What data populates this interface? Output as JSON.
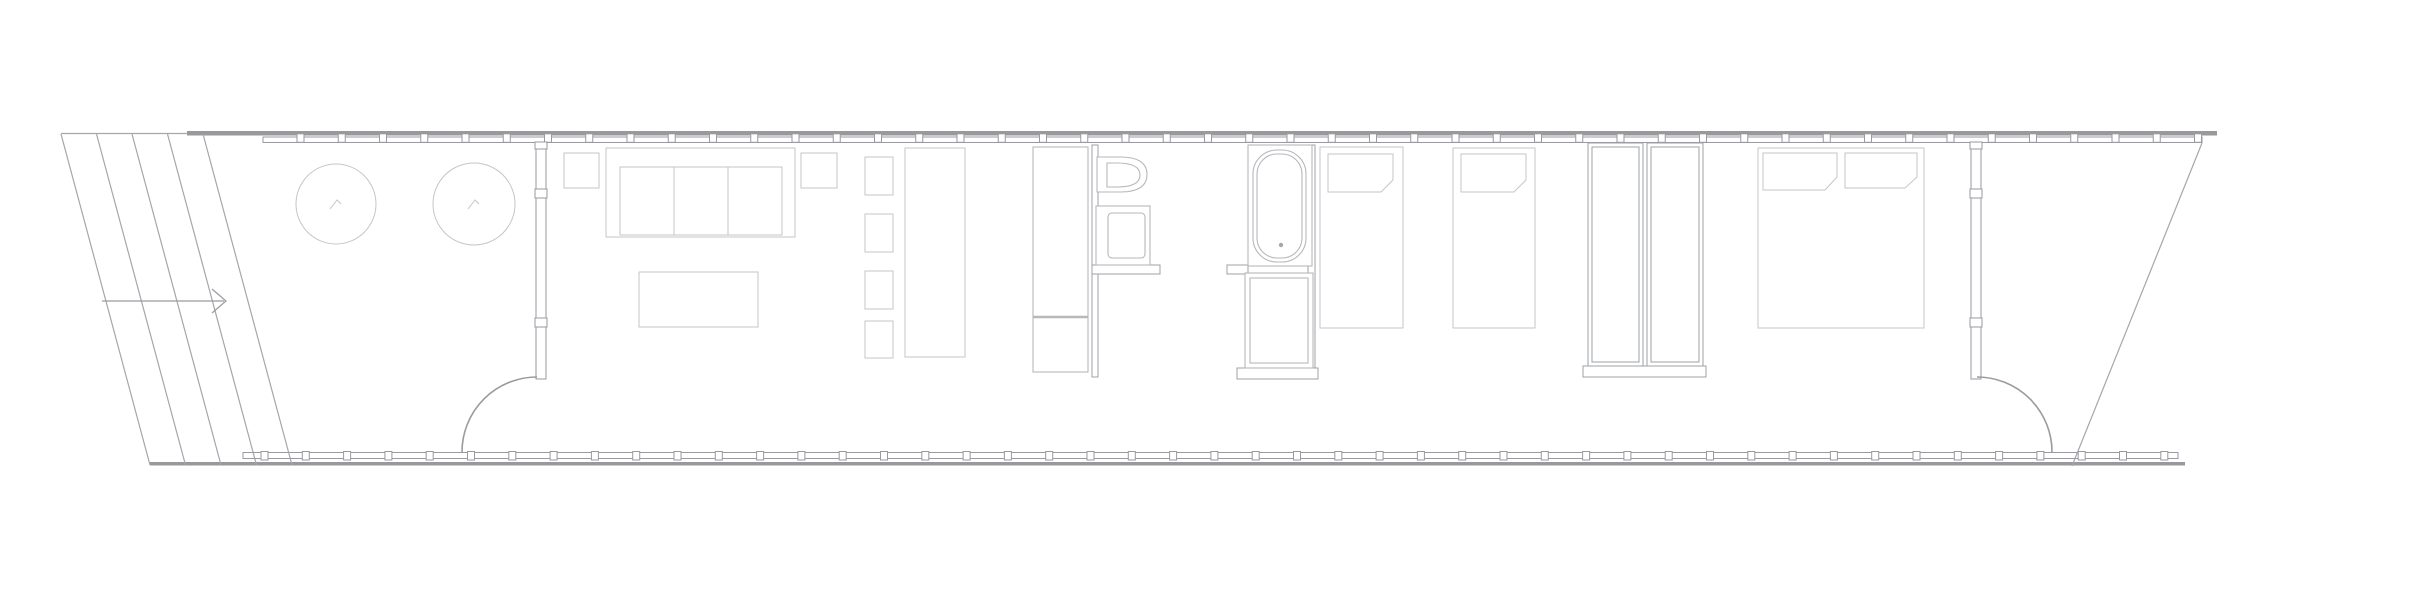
{
  "meta": {
    "title": "Elongated pavilion floor plan — line drawing",
    "canvas": {
      "width": 2409,
      "height": 600,
      "background": "#ffffff"
    },
    "palette": {
      "thick_edge": "#98989d",
      "outline": "#a6a6ab",
      "facade": "#9a9aa0",
      "partition": "#9fa0a4",
      "fixture": "#b7b7bc",
      "furniture": "#c6c6ca",
      "annotation": "#9a9aa0",
      "paper": "#ffffff"
    }
  },
  "layers": [
    {
      "name": "roof-and-deck-edges",
      "stroke": "none",
      "fill": "#98989d",
      "items": [
        {
          "n": "roof-fascia-top",
          "t": "rect",
          "x": 187,
          "y": 131,
          "w": 2030,
          "h": 4.5
        },
        {
          "n": "deck-edge-bottom",
          "t": "rect",
          "x": 150,
          "y": 462,
          "w": 2035,
          "h": 3.5
        }
      ]
    },
    {
      "name": "site-outline-and-ramp",
      "stroke": "#a6a6ab",
      "sw": 1.2,
      "fill": "none",
      "items": [
        {
          "n": "ramp-top-edge",
          "t": "line",
          "x1": 61,
          "y1": 133.5,
          "x2": 187,
          "y2": 133.5
        },
        {
          "n": "ramp-edge-1",
          "t": "line",
          "x1": 61,
          "y1": 134,
          "x2": 150,
          "y2": 465
        },
        {
          "n": "ramp-edge-2",
          "t": "line",
          "x1": 96.5,
          "y1": 134,
          "x2": 185.5,
          "y2": 465
        },
        {
          "n": "ramp-edge-3",
          "t": "line",
          "x1": 132,
          "y1": 134,
          "x2": 221,
          "y2": 465
        },
        {
          "n": "ramp-edge-4",
          "t": "line",
          "x1": 167.5,
          "y1": 134,
          "x2": 256.5,
          "y2": 465
        },
        {
          "n": "ramp-edge-5",
          "t": "line",
          "x1": 203,
          "y1": 134,
          "x2": 292,
          "y2": 465
        },
        {
          "n": "deck-edge-right-diagonal",
          "t": "line",
          "x1": 2202,
          "y1": 143,
          "x2": 2072,
          "y2": 466
        }
      ]
    },
    {
      "name": "glazed-facades",
      "stroke": "#9a9aa0",
      "sw": 1,
      "fill": "#ffffff",
      "items": [
        {
          "n": "glazed-facade-top",
          "t": "rect",
          "x": 263,
          "y": 137,
          "w": 1939,
          "h": 5.5,
          "f": "none"
        },
        {
          "n": "glazed-facade-bottom",
          "t": "rect",
          "x": 243,
          "y": 452.5,
          "w": 1935,
          "h": 6,
          "f": "none"
        },
        {
          "n": "facade-mullions-top",
          "t": "ticks",
          "x0": 297,
          "y": 133.8,
          "step": 41.25,
          "count": 47,
          "w": 7,
          "h": 8.5
        },
        {
          "n": "facade-mullions-bottom",
          "t": "ticks",
          "x0": 261,
          "y": 451.5,
          "step": 41.3,
          "count": 47,
          "w": 7,
          "h": 8.5
        },
        {
          "n": "entry-wall-left",
          "t": "rect",
          "x": 536,
          "y": 142,
          "w": 10,
          "h": 237
        },
        {
          "n": "entry-wall-left-mullion-1",
          "t": "rect",
          "x": 535,
          "y": 142,
          "w": 12,
          "h": 7
        },
        {
          "n": "entry-wall-left-mullion-2",
          "t": "rect",
          "x": 535,
          "y": 189,
          "w": 12,
          "h": 9
        },
        {
          "n": "entry-wall-left-mullion-3",
          "t": "rect",
          "x": 535,
          "y": 318,
          "w": 12,
          "h": 9
        },
        {
          "n": "entry-wall-right",
          "t": "rect",
          "x": 1971,
          "y": 142,
          "w": 10,
          "h": 237
        },
        {
          "n": "entry-wall-right-mullion-1",
          "t": "rect",
          "x": 1970,
          "y": 142,
          "w": 12,
          "h": 7
        },
        {
          "n": "entry-wall-right-mullion-2",
          "t": "rect",
          "x": 1970,
          "y": 189,
          "w": 12,
          "h": 9
        },
        {
          "n": "entry-wall-right-mullion-3",
          "t": "rect",
          "x": 1970,
          "y": 318,
          "w": 12,
          "h": 9
        },
        {
          "n": "entry-door-left-swing",
          "t": "path",
          "d": "M537,377 A75,75 0 0 0 462,452",
          "sw": 1.6,
          "f": "none"
        },
        {
          "n": "entry-door-right-swing",
          "t": "path",
          "d": "M1977,377 A75,75 0 0 1 2052,452",
          "sw": 1.6,
          "f": "none"
        }
      ]
    },
    {
      "name": "interior-partitions",
      "stroke": "#9fa0a4",
      "sw": 1,
      "fill": "#ffffff",
      "items": [
        {
          "n": "bathroom-wall-left",
          "t": "rect",
          "x": 1092,
          "y": 145,
          "w": 6,
          "h": 232
        },
        {
          "n": "bathroom-wall-right",
          "t": "rect",
          "x": 1308,
          "y": 145,
          "w": 7,
          "h": 232
        },
        {
          "n": "bathroom-halfwall-left",
          "t": "rect",
          "x": 1092,
          "y": 265,
          "w": 68,
          "h": 9
        },
        {
          "n": "bathroom-halfwall-right",
          "t": "rect",
          "x": 1227,
          "y": 265,
          "w": 21,
          "h": 9
        },
        {
          "n": "bathroom-wall-bottom",
          "t": "rect",
          "x": 1237,
          "y": 368,
          "w": 81,
          "h": 11
        },
        {
          "n": "wardrobe-1",
          "t": "rect",
          "x": 1588,
          "y": 143,
          "w": 55,
          "h": 223
        },
        {
          "n": "wardrobe-1-inner",
          "t": "rect",
          "x": 1592,
          "y": 147,
          "w": 47,
          "h": 215,
          "f": "none"
        },
        {
          "n": "wardrobe-2",
          "t": "rect",
          "x": 1647,
          "y": 143,
          "w": 56,
          "h": 223
        },
        {
          "n": "wardrobe-2-inner",
          "t": "rect",
          "x": 1651,
          "y": 147,
          "w": 48,
          "h": 215,
          "f": "none"
        },
        {
          "n": "wardrobe-base",
          "t": "rect",
          "x": 1583,
          "y": 366,
          "w": 123,
          "h": 11
        }
      ]
    },
    {
      "name": "fixtures",
      "stroke": "#b7b7bc",
      "sw": 1.1,
      "fill": "#ffffff",
      "items": [
        {
          "n": "kitchen-unit",
          "t": "rect",
          "x": 1033,
          "y": 147,
          "w": 55,
          "h": 225
        },
        {
          "n": "kitchen-unit-divider",
          "t": "line",
          "x1": 1033,
          "y1": 317,
          "x2": 1088,
          "y2": 317,
          "sw": 2.5
        },
        {
          "n": "toilet",
          "t": "path",
          "d": "M1097,157 L1120,157 Q1147,157 1147,174.5 Q1147,192 1120,192 L1097,192 Z"
        },
        {
          "n": "toilet-inner",
          "t": "path",
          "d": "M1107,163 L1117,163 Q1140,163 1140,175 Q1140,187 1117,187 L1107,187 Z",
          "f": "none"
        },
        {
          "n": "sink-counter",
          "t": "rect",
          "x": 1096,
          "y": 206,
          "w": 54,
          "h": 59
        },
        {
          "n": "sink-basin",
          "t": "rect",
          "x": 1108,
          "y": 213,
          "w": 37,
          "h": 45,
          "rx": 4,
          "f": "none"
        },
        {
          "n": "bathtub-enclosure",
          "t": "rect",
          "x": 1248,
          "y": 145,
          "w": 64,
          "h": 121
        },
        {
          "n": "bathtub",
          "t": "rect",
          "x": 1253,
          "y": 150,
          "w": 53,
          "h": 112,
          "rx": 24,
          "f": "none"
        },
        {
          "n": "bathtub-inner",
          "t": "rect",
          "x": 1257,
          "y": 154,
          "w": 45,
          "h": 104,
          "rx": 20,
          "f": "none"
        },
        {
          "n": "bathtub-drain",
          "t": "circle",
          "cx": 1281,
          "cy": 245,
          "r": 2.2,
          "f": "#a6a6ab",
          "sk": "none"
        },
        {
          "n": "shower",
          "t": "rect",
          "x": 1245,
          "y": 273,
          "w": 68,
          "h": 95
        },
        {
          "n": "shower-inner",
          "t": "rect",
          "x": 1250,
          "y": 278,
          "w": 58,
          "h": 85,
          "f": "none"
        }
      ]
    },
    {
      "name": "furniture",
      "stroke": "#c6c6ca",
      "sw": 1,
      "fill": "#ffffff",
      "items": [
        {
          "n": "planter-tree-1",
          "t": "circle",
          "cx": 336,
          "cy": 204,
          "r": 40,
          "f": "none"
        },
        {
          "n": "planter-tree-1-mark",
          "t": "polyline",
          "pts": "330,209 337,200 341,204",
          "f": "none"
        },
        {
          "n": "planter-tree-2",
          "t": "circle",
          "cx": 474,
          "cy": 204,
          "r": 41,
          "f": "none"
        },
        {
          "n": "planter-tree-2-mark",
          "t": "polyline",
          "pts": "468,209 475,200 479,204",
          "f": "none"
        },
        {
          "n": "side-table-1",
          "t": "rect",
          "x": 564,
          "y": 153,
          "w": 35,
          "h": 35
        },
        {
          "n": "sofa",
          "t": "rect",
          "x": 606,
          "y": 148,
          "w": 189,
          "h": 89
        },
        {
          "n": "sofa-seat",
          "t": "rect",
          "x": 620,
          "y": 167,
          "w": 162,
          "h": 68,
          "f": "none"
        },
        {
          "n": "sofa-cushion-divider-1",
          "t": "line",
          "x1": 674,
          "y1": 167,
          "x2": 674,
          "y2": 235
        },
        {
          "n": "sofa-cushion-divider-2",
          "t": "line",
          "x1": 728,
          "y1": 167,
          "x2": 728,
          "y2": 235
        },
        {
          "n": "side-table-2",
          "t": "rect",
          "x": 801,
          "y": 153,
          "w": 36,
          "h": 35
        },
        {
          "n": "coffee-table",
          "t": "rect",
          "x": 639,
          "y": 272,
          "w": 119,
          "h": 55
        },
        {
          "n": "dining-chair-1",
          "t": "rect",
          "x": 865,
          "y": 157,
          "w": 28,
          "h": 38
        },
        {
          "n": "dining-chair-2",
          "t": "rect",
          "x": 865,
          "y": 214,
          "w": 28,
          "h": 38
        },
        {
          "n": "dining-chair-3",
          "t": "rect",
          "x": 865,
          "y": 271,
          "w": 28,
          "h": 38
        },
        {
          "n": "dining-chair-4",
          "t": "rect",
          "x": 865,
          "y": 321,
          "w": 28,
          "h": 37
        },
        {
          "n": "dining-table",
          "t": "rect",
          "x": 905,
          "y": 148,
          "w": 60,
          "h": 209
        },
        {
          "n": "bed-single-1",
          "t": "rect",
          "x": 1320,
          "y": 147,
          "w": 83,
          "h": 181
        },
        {
          "n": "bed-single-1-pillow",
          "t": "path",
          "d": "M1328,154 L1393,154 L1393,180 L1381,192 L1328,192 Z",
          "f": "none"
        },
        {
          "n": "bed-single-2",
          "t": "rect",
          "x": 1453,
          "y": 148,
          "w": 82,
          "h": 180
        },
        {
          "n": "bed-single-2-pillow",
          "t": "path",
          "d": "M1461,154 L1526,154 L1526,180 L1514,192 L1461,192 Z",
          "f": "none"
        },
        {
          "n": "bed-double",
          "t": "rect",
          "x": 1758,
          "y": 148,
          "w": 166,
          "h": 180
        },
        {
          "n": "bed-double-pillow-left",
          "t": "path",
          "d": "M1763,153 L1837,153 L1837,177 L1825,190 L1763,190 Z",
          "f": "none"
        },
        {
          "n": "bed-double-pillow-right",
          "t": "path",
          "d": "M1845,153 L1917,153 L1917,177 L1905,188 L1845,188 Z",
          "f": "none"
        }
      ]
    },
    {
      "name": "annotations",
      "stroke": "#9a9aa0",
      "sw": 1.2,
      "fill": "none",
      "items": [
        {
          "n": "entry-arrow-line",
          "t": "line",
          "x1": 102,
          "y1": 301,
          "x2": 224,
          "y2": 301
        },
        {
          "n": "entry-arrow-head",
          "t": "polyline",
          "pts": "212,289 226,301 212,313"
        }
      ]
    }
  ]
}
